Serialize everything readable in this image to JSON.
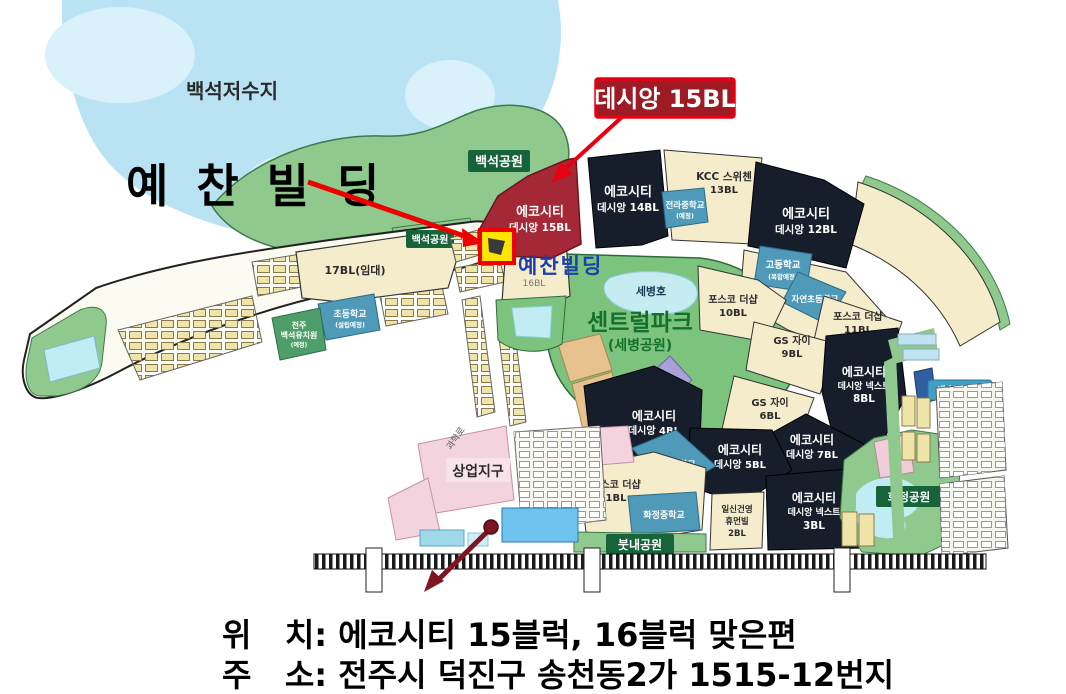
{
  "colors": {
    "accent_red": "#e60012",
    "callout_fill": "#9e1b26",
    "highlight_yellow": "#ffe400",
    "building_label_blue": "#1c3fae",
    "block_dark": "#161d2b",
    "block_red": "#a52836",
    "park_green": "#8fc98e"
  },
  "annotations": {
    "callout_label": "데시앙 15BL",
    "title": "예 찬 빌 딩",
    "map_building_label": "예찬빌딩"
  },
  "captions": {
    "location": "위   치: 에코시티 15블럭, 16블럭 맞은편",
    "address": "주   소: 전주시 덕진구 송천동2가 1515-12번지"
  },
  "map": {
    "reservoir": "백석저수지",
    "park_baekseok": "백석공원",
    "park_baekseok_small": "백석공원",
    "central_park": "센트럴파크",
    "central_park_sub": "(세병공원)",
    "lake_sebyeong": "세병호",
    "park_butnae": "붓내공원",
    "park_hwajeong": "화정공원",
    "kinder_saesol": "새솔유치원",
    "road_gwahak": "과학로",
    "commercial": "상업지구",
    "blocks": {
      "b15": {
        "l1": "에코시티",
        "l2": "데시앙 15BL"
      },
      "b14": {
        "l1": "에코시티",
        "l2": "데시앙 14BL"
      },
      "b13": {
        "l1": "KCC 스위첸",
        "l2": "13BL"
      },
      "b12": {
        "l1": "에코시티",
        "l2": "데시앙 12BL"
      },
      "b11": {
        "l1": "포스코 더샵",
        "l2": "11BL"
      },
      "b10": {
        "l1": "포스코 더샵",
        "l2": "10BL"
      },
      "b9": {
        "l1": "GS 자이",
        "l2": "9BL"
      },
      "b8": {
        "l1": "에코시티",
        "l2": "데시앙 넥스트",
        "l3": "8BL"
      },
      "b7": {
        "l1": "에코시티",
        "l2": "데시앙 7BL"
      },
      "b6": {
        "l1": "GS 자이",
        "l2": "6BL"
      },
      "b5": {
        "l1": "에코시티",
        "l2": "데시앙 5BL"
      },
      "b4": {
        "l1": "에코시티",
        "l2": "데시앙 4BL"
      },
      "b3": {
        "l1": "에코시티",
        "l2": "데시앙 넥스트",
        "l3": "3BL"
      },
      "b2": {
        "l1": "일신건영",
        "l2": "휴먼빌",
        "l3": "2BL"
      },
      "b1": {
        "l1": "포스코 더샵",
        "l2": "1BL"
      },
      "b17": {
        "l1": "17BL(임대)"
      },
      "b16": {
        "l1": "16BL"
      }
    },
    "schools": {
      "jeonra": {
        "l1": "전라중학교",
        "l2": "(예정)"
      },
      "high": {
        "l1": "고등학교",
        "l2": "(복합예정)"
      },
      "jayeon": {
        "l1": "자연초등학교"
      },
      "hwajeong_elem": {
        "l1": "화정초등학교"
      },
      "hwajeong_mid": {
        "l1": "화정중학교"
      },
      "penin_elem": {
        "l1": "초등학교",
        "l2": "(설립예정)"
      },
      "baekseok_kinder": {
        "l1": "전주",
        "l2": "백석유치원",
        "l3": "(예정)"
      }
    }
  }
}
